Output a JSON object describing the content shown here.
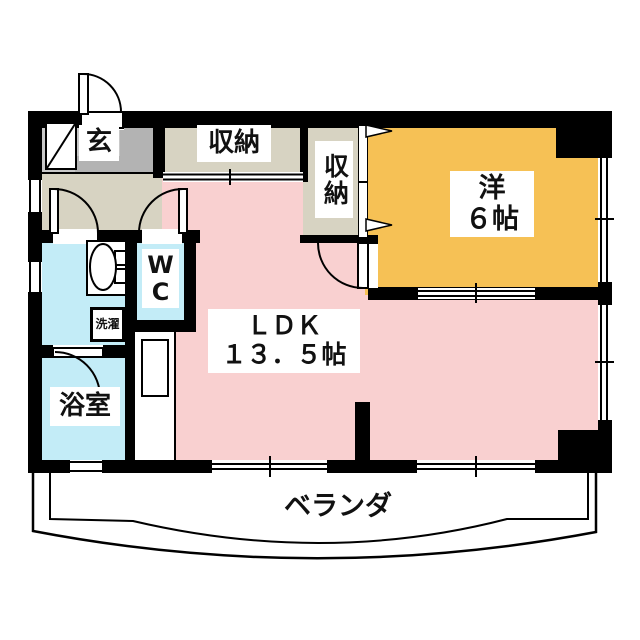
{
  "plan_title": "apartment-floor-plan",
  "rooms": {
    "entrance": {
      "label": "玄"
    },
    "storage_top": {
      "label": "収納"
    },
    "storage_side": {
      "label": "収納"
    },
    "western": {
      "name": "洋",
      "size": "６帖"
    },
    "ldk": {
      "name": "ＬＤＫ",
      "size": "１３．５帖"
    },
    "wc": {
      "line1": "W",
      "line2": "C"
    },
    "laundry": {
      "label": "洗濯"
    },
    "bathroom": {
      "label": "浴室"
    },
    "veranda": {
      "label": "ベランダ"
    }
  },
  "colors": {
    "ldk_pink": "#f9d0d0",
    "western_orange": "#f6c155",
    "wet_cyan": "#c3ecf7",
    "hall_beige": "#d7d3c2",
    "genkan_gray": "#c8c8c8",
    "genkan_step_gray": "#b3b3b3",
    "wall_black": "#000000"
  }
}
